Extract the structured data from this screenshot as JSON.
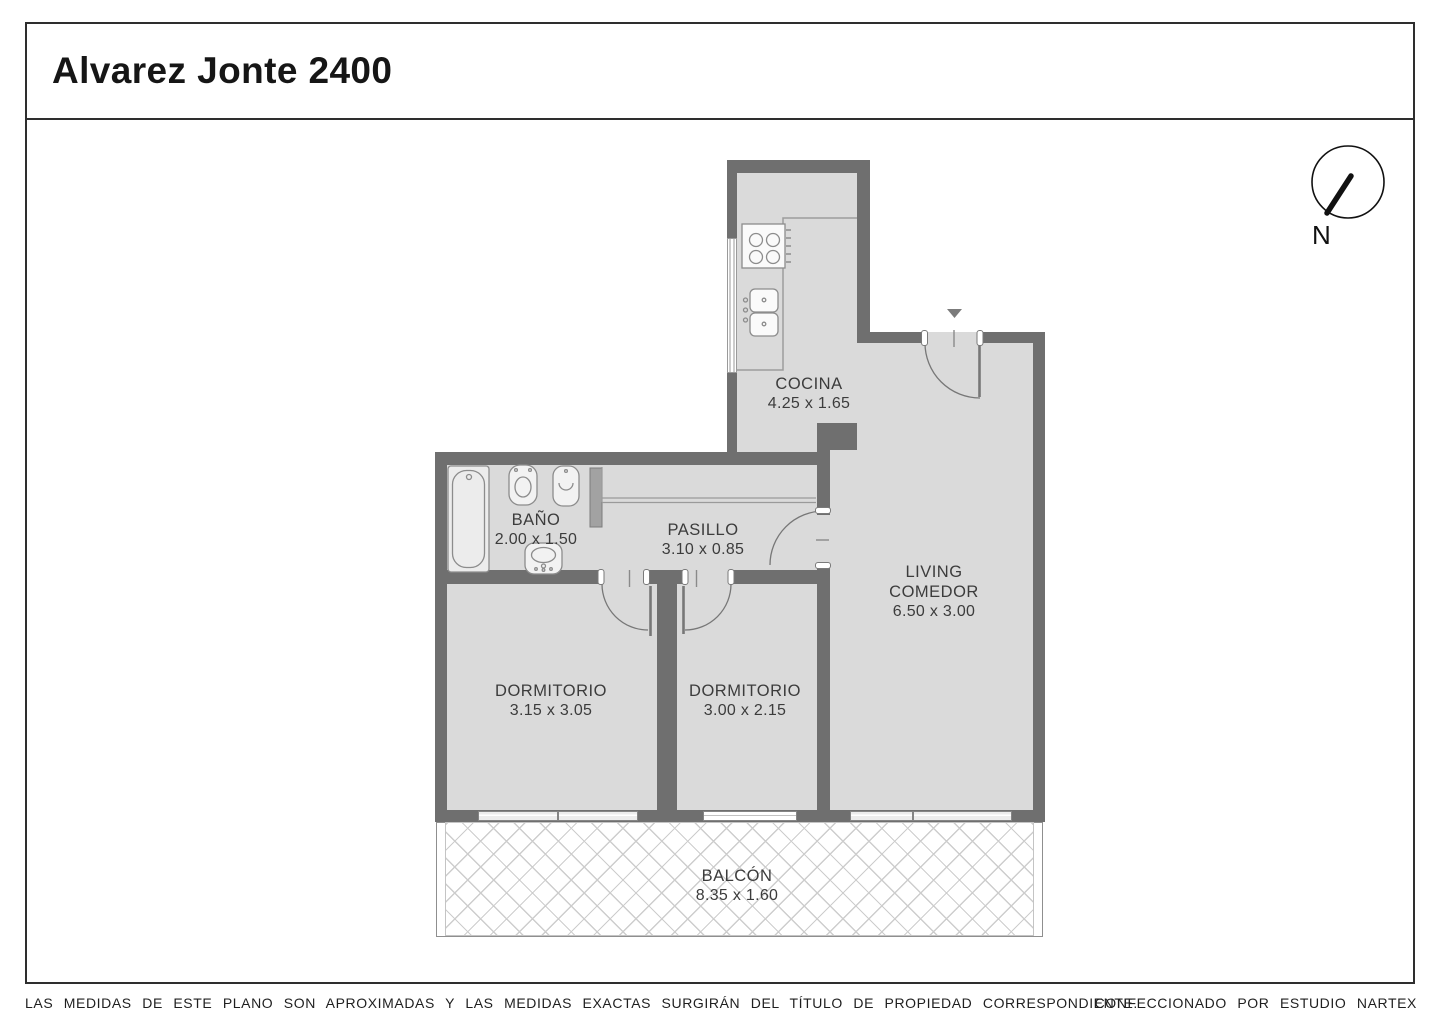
{
  "title": "Alvarez Jonte 2400",
  "compass": {
    "north_label": "N"
  },
  "rooms": {
    "cocina": {
      "name": "COCINA",
      "dims": "4.25 x 1.65"
    },
    "bano": {
      "name": "BAÑO",
      "dims": "2.00 x 1.50"
    },
    "pasillo": {
      "name": "PASILLO",
      "dims": "3.10 x 0.85"
    },
    "living_comedor": {
      "name_line1": "LIVING",
      "name_line2": "COMEDOR",
      "dims": "6.50 x 3.00"
    },
    "dormitorio_1": {
      "name": "DORMITORIO",
      "dims": "3.15 x 3.05"
    },
    "dormitorio_2": {
      "name": "DORMITORIO",
      "dims": "3.00 x 2.15"
    },
    "balcon": {
      "name": "BALCÓN",
      "dims": "8.35 x 1.60"
    }
  },
  "footer": {
    "disclaimer": "LAS MEDIDAS DE ESTE PLANO SON APROXIMADAS Y LAS MEDIDAS EXACTAS SURGIRÁN DEL TÍTULO DE PROPIEDAD CORRESPONDIENTE.",
    "credit": "CONFECCIONADO POR ESTUDIO NARTEX"
  },
  "colors": {
    "wall": "#6f6f6f",
    "floor": "#dadada",
    "label_text": "#3c3c3c",
    "fixture_line": "#8c8c8c"
  }
}
